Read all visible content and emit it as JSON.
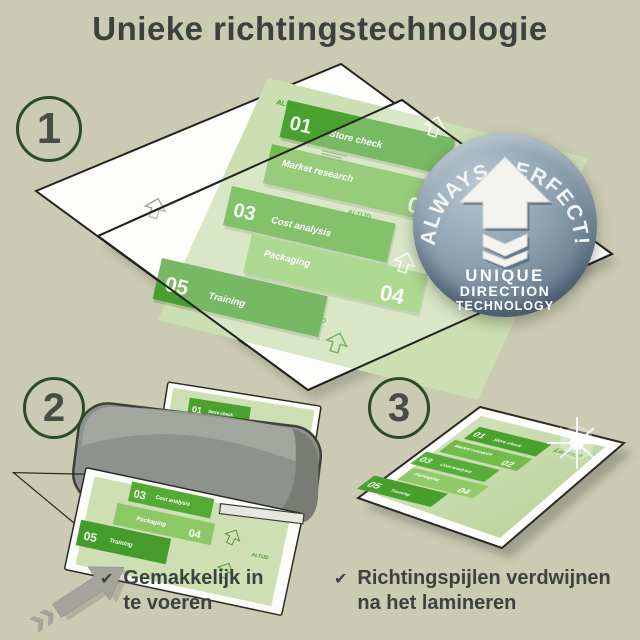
{
  "title": "Unieke richtingstechnologie",
  "steps": {
    "one": "1",
    "two": "2",
    "three": "3"
  },
  "badge": {
    "arc": "ALWAYS PERFECT!",
    "line1": "UNIQUE",
    "line2": "DIRECTION",
    "line3": "TECHNOLOGY"
  },
  "doc": {
    "band1_num": "01",
    "band1_label": "Store check",
    "band2_label": "Market research",
    "band2_num": "02",
    "band3_num": "03",
    "band3_label": "Cost analysis",
    "band4_label": "Packaging",
    "band4_num": "04",
    "band5_num": "05",
    "band5_label": "Training",
    "launch": "Launch",
    "watermark": "ALTIJD"
  },
  "checklist": {
    "check_icon": "✔",
    "item1_line1": "Gemakkelijk in",
    "item1_line2": "te voeren",
    "item2_line1": "Richtingspijlen verdwijnen",
    "item2_line2": "na het lamineren"
  },
  "colors": {
    "background": "#cbcab2",
    "ink": "#3b423e",
    "circle_green": "#2c4b27",
    "badge_blue": "#8ba0af",
    "band_dark": "#4aa12e",
    "band_mid": "#74bb4d",
    "band_mid2": "#58ac38",
    "band_light": "#8fcb69",
    "doc_green": "#cddfb3",
    "launch_green": "#44a52a",
    "machine_gray": "#8e928c",
    "arrow_gray": "#a4a49d"
  }
}
